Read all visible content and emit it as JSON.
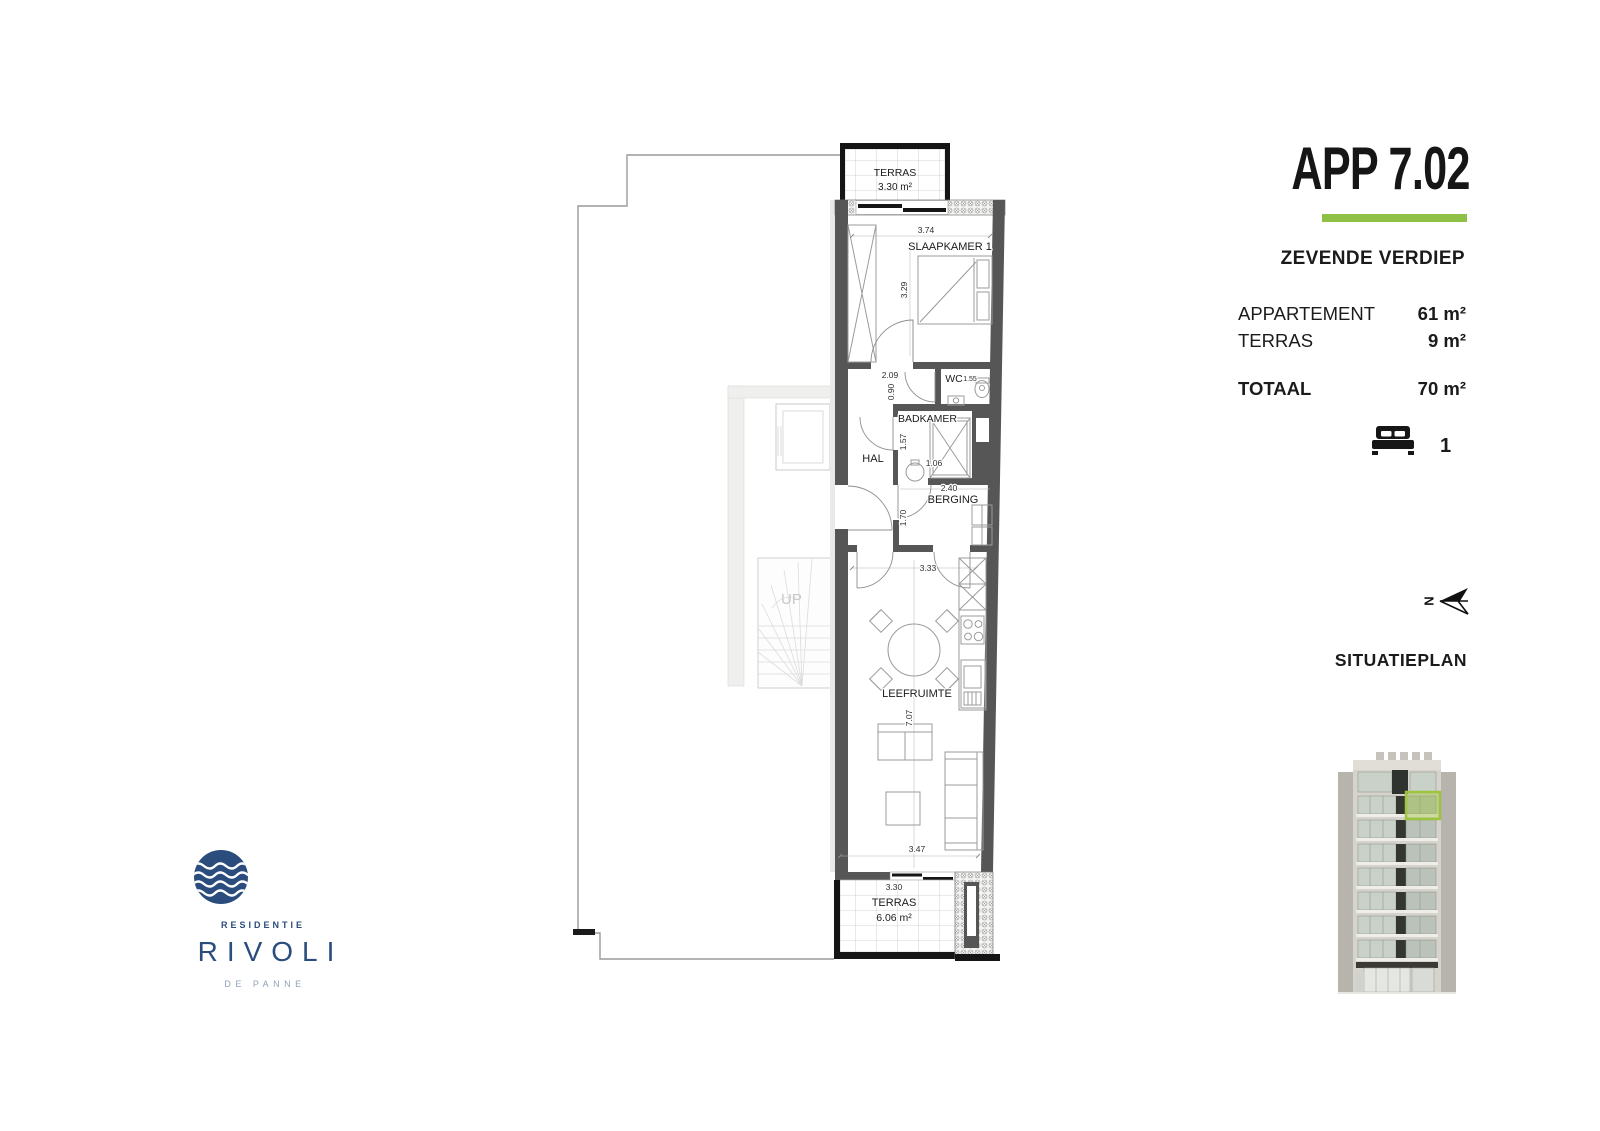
{
  "header": {
    "title": "APP 7.02",
    "floor": "ZEVENDE VERDIEP"
  },
  "areas": {
    "rows": [
      {
        "label": "APPARTEMENT",
        "value": "61 m²"
      },
      {
        "label": "TERRAS",
        "value": "9 m²"
      }
    ],
    "total": {
      "label": "TOTAAL",
      "value": "70 m²"
    }
  },
  "bedrooms": {
    "count": "1"
  },
  "north": {
    "letter": "N"
  },
  "situatieplan": {
    "label": "SITUATIEPLAN"
  },
  "logo": {
    "residentie": "RESIDENTIE",
    "name": "RIVOLI",
    "city": "DE PANNE"
  },
  "colors": {
    "accent": "#8dc044",
    "navy": "#2b4d7d",
    "wall": "#565656"
  },
  "plan": {
    "terras_top": {
      "label": "TERRAS",
      "area": "3.30 m²"
    },
    "slaapkamer": {
      "label": "SLAAPKAMER 1",
      "dim_w": "3.74",
      "dim_h": "3.29"
    },
    "hal": {
      "label": "HAL",
      "dim_w": "2.09",
      "dim_h": "0.90"
    },
    "wc": {
      "label": "WC",
      "dim": "1.55"
    },
    "badkamer": {
      "label": "BADKAMER",
      "dim_h": "1.57",
      "dim_w": "1.06"
    },
    "berging": {
      "label": "BERGING",
      "dim_w": "2.40",
      "dim_h": "1.70"
    },
    "leefruimte": {
      "label": "LEEFRUIMTE",
      "dim_top": "3.33",
      "dim_h": "7.07",
      "dim_bottom": "3.47"
    },
    "terras_bottom": {
      "label": "TERRAS",
      "dim": "3.30",
      "area": "6.06 m²"
    },
    "stairs": {
      "label": "UP"
    }
  }
}
